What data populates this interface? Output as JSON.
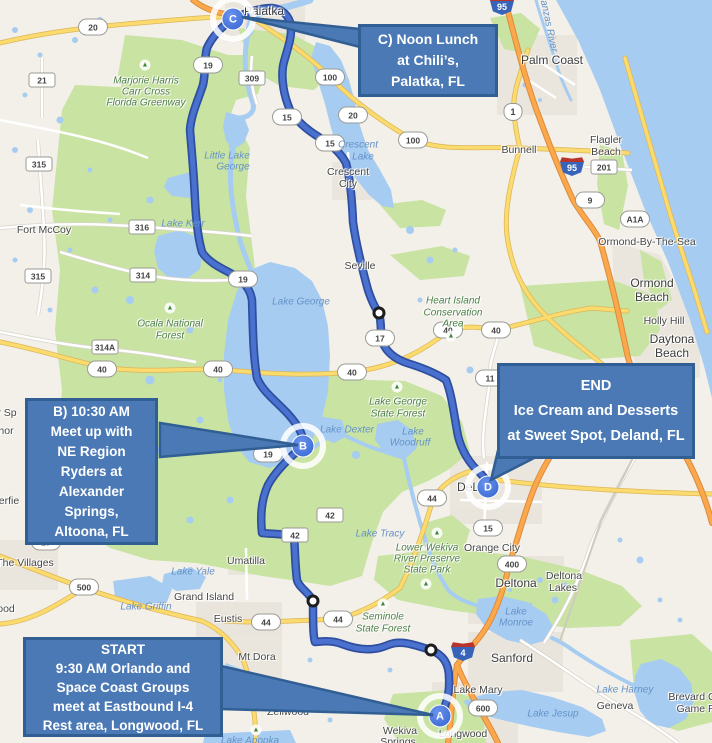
{
  "colors": {
    "land": "#f3f0e9",
    "water": "#a6ccf2",
    "green": "#c9e3a2",
    "urban": "#e7e3da",
    "road_yellow": "#fbda6e",
    "road_yellow_casing": "#dcb659",
    "road_orange": "#faa84b",
    "road_orange_casing": "#dd8a3c",
    "route": "#4a71cf",
    "route_casing": "#2e4f9e",
    "callout_fill": "#4a79b5",
    "callout_border": "#315e93"
  },
  "callouts": {
    "c": {
      "lines": [
        "C) Noon Lunch",
        "at Chili’s,",
        "Palatka, FL"
      ]
    },
    "b": {
      "lines": [
        "B) 10:30 AM",
        "Meet up with",
        "NE Region",
        "Ryders at",
        "Alexander",
        "Springs,",
        "Altoona, FL"
      ]
    },
    "end": {
      "lines": [
        "END",
        "Ice Cream and Desserts",
        "at Sweet Spot, Deland, FL"
      ]
    },
    "start": {
      "lines": [
        "START",
        "9:30 AM Orlando and",
        "Space Coast Groups",
        "meet at Eastbound I-4",
        "Rest area, Longwood, FL"
      ]
    }
  },
  "markers": [
    {
      "label": "A",
      "x": 440,
      "y": 716
    },
    {
      "label": "B",
      "x": 303,
      "y": 446
    },
    {
      "label": "C",
      "x": 233,
      "y": 19
    },
    {
      "label": "D",
      "x": 488,
      "y": 487
    }
  ],
  "waypoints": [
    {
      "x": 379,
      "y": 313
    },
    {
      "x": 313,
      "y": 601
    },
    {
      "x": 431,
      "y": 650
    }
  ],
  "trees": [
    {
      "x": 145,
      "y": 65
    },
    {
      "x": 170,
      "y": 308
    },
    {
      "x": 397,
      "y": 387
    },
    {
      "x": 451,
      "y": 336
    },
    {
      "x": 426,
      "y": 584
    },
    {
      "x": 383,
      "y": 604
    },
    {
      "x": 256,
      "y": 730
    },
    {
      "x": 437,
      "y": 533
    }
  ],
  "map_labels": [
    {
      "t": "Palatka",
      "x": 264,
      "y": 11,
      "c": "city-lg"
    },
    {
      "t": "Palm Coast",
      "x": 552,
      "y": 60,
      "c": "city-lg"
    },
    {
      "t": "Bunnell",
      "x": 519,
      "y": 150,
      "c": "city"
    },
    {
      "t": "Flagler",
      "x": 606,
      "y": 140,
      "c": "city"
    },
    {
      "t": "Beach",
      "x": 606,
      "y": 152,
      "c": "city"
    },
    {
      "t": "Fort McCoy",
      "x": 44,
      "y": 230,
      "c": "city"
    },
    {
      "t": "Crescent",
      "x": 348,
      "y": 172,
      "c": "city"
    },
    {
      "t": "City",
      "x": 348,
      "y": 184,
      "c": "city"
    },
    {
      "t": "Seville",
      "x": 360,
      "y": 266,
      "c": "city"
    },
    {
      "t": "Ormond-By-The-Sea",
      "x": 647,
      "y": 242,
      "c": "city"
    },
    {
      "t": "Ormond",
      "x": 652,
      "y": 283,
      "c": "city-lg"
    },
    {
      "t": "Beach",
      "x": 652,
      "y": 297,
      "c": "city-lg"
    },
    {
      "t": "Holly Hill",
      "x": 664,
      "y": 321,
      "c": "city"
    },
    {
      "t": "Daytona",
      "x": 672,
      "y": 339,
      "c": "city-lg"
    },
    {
      "t": "Beach",
      "x": 672,
      "y": 353,
      "c": "city-lg"
    },
    {
      "t": "Orange City",
      "x": 492,
      "y": 548,
      "c": "city"
    },
    {
      "t": "Deltona",
      "x": 516,
      "y": 583,
      "c": "city-lg"
    },
    {
      "t": "Deltona",
      "x": 564,
      "y": 576,
      "c": "city"
    },
    {
      "t": "Lakes",
      "x": 563,
      "y": 588,
      "c": "city"
    },
    {
      "t": "DeLand",
      "x": 478,
      "y": 487,
      "c": "city-lg"
    },
    {
      "t": "Sanford",
      "x": 512,
      "y": 658,
      "c": "city-lg"
    },
    {
      "t": "Lake Mary",
      "x": 478,
      "y": 690,
      "c": "city"
    },
    {
      "t": "Longwood",
      "x": 463,
      "y": 734,
      "c": "city"
    },
    {
      "t": "Wekiva",
      "x": 400,
      "y": 731,
      "c": "city"
    },
    {
      "t": "Springs",
      "x": 398,
      "y": 742,
      "c": "city"
    },
    {
      "t": "Geneva",
      "x": 615,
      "y": 706,
      "c": "city"
    },
    {
      "t": "Umatilla",
      "x": 246,
      "y": 561,
      "c": "city"
    },
    {
      "t": "Eustis",
      "x": 228,
      "y": 619,
      "c": "city"
    },
    {
      "t": "Mt Dora",
      "x": 257,
      "y": 657,
      "c": "city"
    },
    {
      "t": "Grand Island",
      "x": 204,
      "y": 597,
      "c": "city"
    },
    {
      "t": "Zellwood",
      "x": 288,
      "y": 712,
      "c": "city"
    },
    {
      "t": "The Villages",
      "x": 25,
      "y": 563,
      "c": "city"
    },
    {
      "t": "Brevard C",
      "x": 692,
      "y": 697,
      "c": "city"
    },
    {
      "t": "Game R",
      "x": 696,
      "y": 709,
      "c": "city"
    },
    {
      "t": "r Sp",
      "x": 7,
      "y": 413,
      "c": "city"
    },
    {
      "t": "hor",
      "x": 6,
      "y": 431,
      "c": "city"
    },
    {
      "t": "erfie",
      "x": 9,
      "y": 501,
      "c": "city"
    },
    {
      "t": "ood",
      "x": 6,
      "y": 609,
      "c": "city"
    },
    {
      "t": "Crescent",
      "x": 358,
      "y": 145,
      "c": "water"
    },
    {
      "t": "Lake",
      "x": 363,
      "y": 157,
      "c": "water"
    },
    {
      "t": "Lake George",
      "x": 301,
      "y": 302,
      "c": "water"
    },
    {
      "t": "Little Lake",
      "x": 227,
      "y": 156,
      "c": "water"
    },
    {
      "t": "George",
      "x": 233,
      "y": 167,
      "c": "water"
    },
    {
      "t": "Lake Kerr",
      "x": 183,
      "y": 224,
      "c": "water"
    },
    {
      "t": "Lake Dexter",
      "x": 347,
      "y": 430,
      "c": "water"
    },
    {
      "t": "Lake",
      "x": 413,
      "y": 432,
      "c": "water"
    },
    {
      "t": "Woodruff",
      "x": 410,
      "y": 443,
      "c": "water"
    },
    {
      "t": "Lake Tracy",
      "x": 380,
      "y": 534,
      "c": "water"
    },
    {
      "t": "Lake",
      "x": 516,
      "y": 612,
      "c": "water"
    },
    {
      "t": "Monroe",
      "x": 516,
      "y": 623,
      "c": "water"
    },
    {
      "t": "Lake Jesup",
      "x": 553,
      "y": 714,
      "c": "water"
    },
    {
      "t": "Lake Harney",
      "x": 625,
      "y": 690,
      "c": "water"
    },
    {
      "t": "Lake Griffin",
      "x": 146,
      "y": 607,
      "c": "water"
    },
    {
      "t": "Lake Yale",
      "x": 193,
      "y": 572,
      "c": "water"
    },
    {
      "t": "Lake Apopka",
      "x": 250,
      "y": 741,
      "c": "water"
    },
    {
      "t": "Dora",
      "x": 235,
      "y": 673,
      "c": "water"
    },
    {
      "t": "Matanzas River",
      "x": 547,
      "y": 18,
      "c": "water",
      "r": 78
    },
    {
      "t": "Marjorie Harris",
      "x": 146,
      "y": 81,
      "c": "park"
    },
    {
      "t": "Carr Cross",
      "x": 146,
      "y": 92,
      "c": "park"
    },
    {
      "t": "Florida Greenway",
      "x": 146,
      "y": 103,
      "c": "park"
    },
    {
      "t": "Ocala National",
      "x": 170,
      "y": 324,
      "c": "park"
    },
    {
      "t": "Forest",
      "x": 170,
      "y": 336,
      "c": "park"
    },
    {
      "t": "Lake George",
      "x": 398,
      "y": 402,
      "c": "park"
    },
    {
      "t": "State Forest",
      "x": 398,
      "y": 414,
      "c": "park"
    },
    {
      "t": "Heart Island",
      "x": 453,
      "y": 301,
      "c": "park"
    },
    {
      "t": "Conservation",
      "x": 453,
      "y": 313,
      "c": "park"
    },
    {
      "t": "Area",
      "x": 453,
      "y": 324,
      "c": "park"
    },
    {
      "t": "Seminole",
      "x": 383,
      "y": 617,
      "c": "park"
    },
    {
      "t": "State Forest",
      "x": 383,
      "y": 629,
      "c": "park"
    },
    {
      "t": "Lower Wekiva",
      "x": 427,
      "y": 548,
      "c": "park"
    },
    {
      "t": "River Preserve",
      "x": 427,
      "y": 559,
      "c": "park"
    },
    {
      "t": "State Park",
      "x": 427,
      "y": 570,
      "c": "park"
    }
  ],
  "shields": [
    {
      "k": "oval",
      "t": "19",
      "x": 208,
      "y": 65
    },
    {
      "k": "oval",
      "t": "19",
      "x": 243,
      "y": 279
    },
    {
      "k": "oval",
      "t": "19",
      "x": 268,
      "y": 454
    },
    {
      "k": "oval",
      "t": "20",
      "x": 93,
      "y": 27
    },
    {
      "k": "oval",
      "t": "20",
      "x": 353,
      "y": 115
    },
    {
      "k": "oval",
      "t": "100",
      "x": 330,
      "y": 77
    },
    {
      "k": "oval",
      "t": "100",
      "x": 413,
      "y": 140
    },
    {
      "k": "oval",
      "t": "15",
      "x": 287,
      "y": 117
    },
    {
      "k": "oval",
      "t": "15",
      "x": 330,
      "y": 143
    },
    {
      "k": "oval",
      "t": "15",
      "x": 488,
      "y": 528
    },
    {
      "k": "oval",
      "t": "17",
      "x": 380,
      "y": 338
    },
    {
      "k": "oval",
      "t": "40",
      "x": 102,
      "y": 369
    },
    {
      "k": "oval",
      "t": "40",
      "x": 218,
      "y": 369
    },
    {
      "k": "oval",
      "t": "40",
      "x": 352,
      "y": 372
    },
    {
      "k": "oval",
      "t": "40",
      "x": 448,
      "y": 330
    },
    {
      "k": "oval",
      "t": "40",
      "x": 496,
      "y": 330
    },
    {
      "k": "oval",
      "t": "44",
      "x": 266,
      "y": 622
    },
    {
      "k": "oval",
      "t": "44",
      "x": 338,
      "y": 619
    },
    {
      "k": "oval",
      "t": "44",
      "x": 432,
      "y": 498
    },
    {
      "k": "oval",
      "t": "27",
      "x": 46,
      "y": 542
    },
    {
      "k": "oval",
      "t": "500",
      "x": 84,
      "y": 587
    },
    {
      "k": "oval",
      "t": "600",
      "x": 483,
      "y": 708
    },
    {
      "k": "oval",
      "t": "400",
      "x": 512,
      "y": 564
    },
    {
      "k": "oval",
      "t": "9",
      "x": 590,
      "y": 200
    },
    {
      "k": "oval",
      "t": "A1A",
      "x": 635,
      "y": 219
    },
    {
      "k": "oval",
      "t": "11",
      "x": 490,
      "y": 378
    },
    {
      "k": "rect",
      "t": "315",
      "x": 39,
      "y": 164
    },
    {
      "k": "rect",
      "t": "315",
      "x": 38,
      "y": 276
    },
    {
      "k": "rect",
      "t": "316",
      "x": 142,
      "y": 227
    },
    {
      "k": "rect",
      "t": "314",
      "x": 143,
      "y": 275
    },
    {
      "k": "rect",
      "t": "314A",
      "x": 105,
      "y": 347
    },
    {
      "k": "rect",
      "t": "309",
      "x": 252,
      "y": 78
    },
    {
      "k": "rect",
      "t": "201",
      "x": 604,
      "y": 167
    },
    {
      "k": "rect",
      "t": "21",
      "x": 42,
      "y": 80
    },
    {
      "k": "rect",
      "t": "42",
      "x": 330,
      "y": 515
    },
    {
      "k": "rect",
      "t": "42",
      "x": 295,
      "y": 535
    },
    {
      "k": "i",
      "t": "95",
      "x": 502,
      "y": 5
    },
    {
      "k": "i",
      "t": "95",
      "x": 572,
      "y": 166
    },
    {
      "k": "i",
      "t": "4",
      "x": 463,
      "y": 651
    },
    {
      "k": "us",
      "t": "1",
      "x": 513,
      "y": 112
    }
  ]
}
